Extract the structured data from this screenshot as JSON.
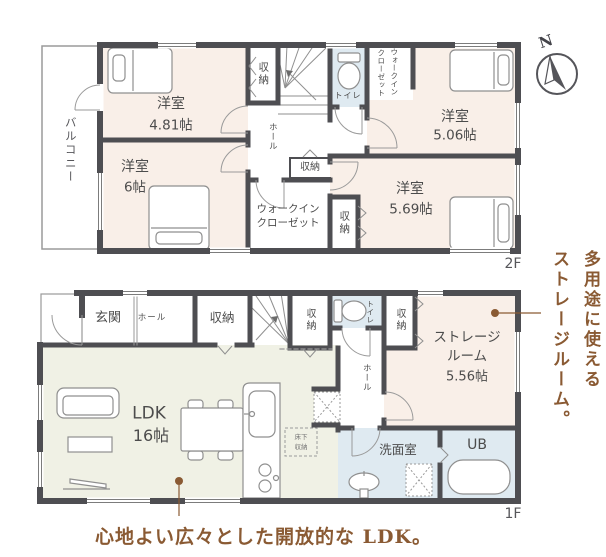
{
  "floor2": {
    "floor_label": "2F",
    "balcony": "バルコニー",
    "room_481_name": "洋室",
    "room_481_size": "4.81帖",
    "room_6_name": "洋室",
    "room_6_size": "6帖",
    "room_506_name": "洋室",
    "room_506_size": "5.06帖",
    "room_569_name": "洋室",
    "room_569_size": "5.69帖",
    "closet_stairs": "収納",
    "toilet": "トイレ",
    "hall": "ホール",
    "wic_top_col1": "ウォークイン",
    "wic_top_col2": "クローゼット",
    "closet_mid": "収納",
    "wic_line1": "ウォークイン",
    "wic_line2": "クローゼット",
    "closet_569": "収納"
  },
  "floor1": {
    "floor_label": "1F",
    "genkan": "玄関",
    "hall_entry": "ホール",
    "closet_entry": "収納",
    "closet_stairs": "収納",
    "toilet": "トイレ",
    "closet_storage": "収納",
    "hall": "ホール",
    "ldk_name": "LDK",
    "ldk_size": "16帖",
    "storage_line1": "ストレージ",
    "storage_line2": "ルーム",
    "storage_size": "5.56帖",
    "underfloor_line1": "床下",
    "underfloor_line2": "収納",
    "senmen": "洗面室",
    "ub": "UB"
  },
  "compass": {
    "north": "N"
  },
  "notes": {
    "storage_col1": "多用途に使える",
    "storage_col2": "ストレージルーム。",
    "ldk_caption": "心地よい広々とした開放的な LDK。"
  },
  "colors": {
    "wall": "#4e4e52",
    "room_pink": "#f9efe8",
    "room_blue": "#dfeaf1",
    "room_green": "#f0f1e5",
    "accent_brown": "#8a5a33"
  }
}
